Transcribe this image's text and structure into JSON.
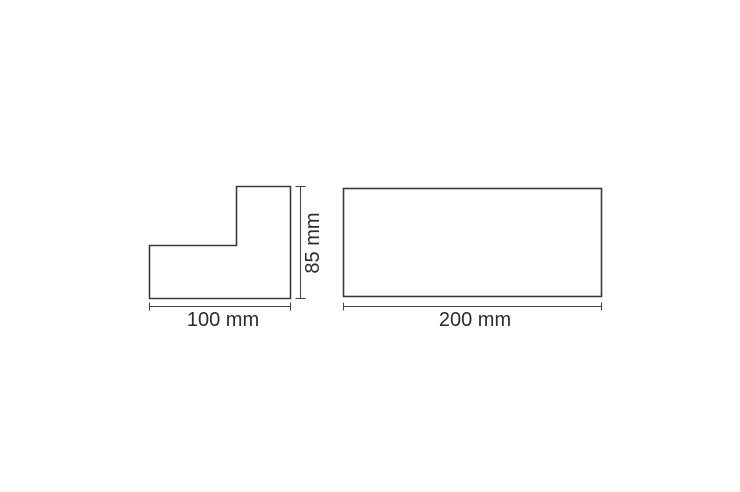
{
  "page": {
    "background_color": "#ffffff"
  },
  "drawing": {
    "stroke_color": "#3b3b3b",
    "dimension_line_color": "#474747",
    "text_color": "#2d2d2d",
    "l_profile": {
      "width_label": "100 mm",
      "height_label": "85 mm",
      "width_mm": 100,
      "height_mm": 85
    },
    "rect_profile": {
      "width_label": "200 mm",
      "width_mm": 200
    }
  }
}
